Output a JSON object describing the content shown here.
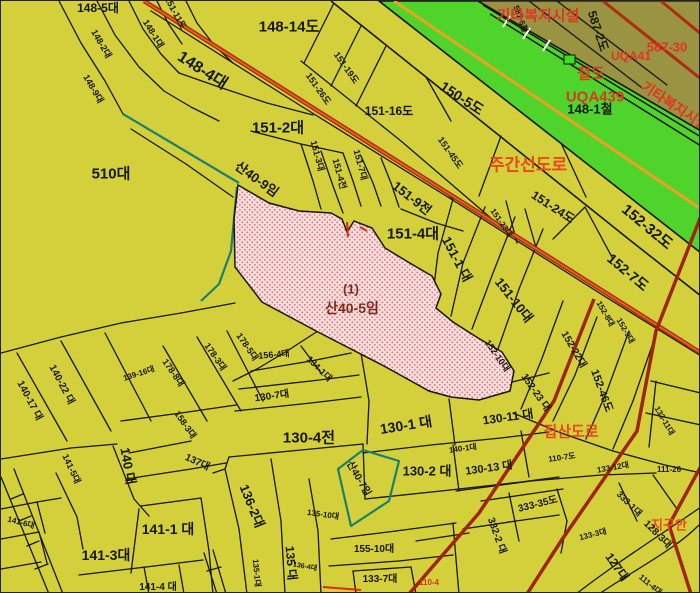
{
  "map": {
    "type": "cadastral-parcel-map",
    "palette": {
      "background": "#d3d03c",
      "olive_zone": "#9a9342",
      "railway_green": "#4fd42c",
      "railway_center_orange": "#efa021",
      "main_road_red": "#a82a10",
      "main_road_core": "#e8611c",
      "minor_road_red": "#9e2610",
      "forest_boundary_teal": "#1b7f6d",
      "highlight_fill": "#f8e0e0",
      "highlight_dot": "#dd7777",
      "ink": "#17160a",
      "road_class": "#e8491d",
      "facility": "#e03522",
      "maroon": "#7d2a1e",
      "tiny_red": "#d93025"
    },
    "highlight_parcel": {
      "marker": "(1)",
      "lot": "산40-5임"
    },
    "labels": [
      {
        "t": "148-5대",
        "x": 97,
        "y": 7,
        "r": 0,
        "s": 12
      },
      {
        "t": "151-11도",
        "x": 174,
        "y": 12,
        "r": 62,
        "s": 9
      },
      {
        "t": "148-14도",
        "x": 288,
        "y": 26,
        "r": 0,
        "s": 15
      },
      {
        "t": "148-4대",
        "x": 201,
        "y": 70,
        "r": 33,
        "s": 16
      },
      {
        "t": "148-1대",
        "x": 152,
        "y": 33,
        "r": 58,
        "s": 9
      },
      {
        "t": "148-2대",
        "x": 100,
        "y": 43,
        "r": 60,
        "s": 9
      },
      {
        "t": "148-9대",
        "x": 92,
        "y": 88,
        "r": 60,
        "s": 9
      },
      {
        "t": "151-2대",
        "x": 277,
        "y": 127,
        "r": 0,
        "s": 15
      },
      {
        "t": "510대",
        "x": 110,
        "y": 173,
        "r": 0,
        "s": 15
      },
      {
        "t": "산40-9임",
        "x": 256,
        "y": 178,
        "r": 36,
        "s": 13
      },
      {
        "t": "150-5도",
        "x": 461,
        "y": 97,
        "r": 33,
        "s": 14
      },
      {
        "t": "151-16도",
        "x": 388,
        "y": 110,
        "r": 0,
        "s": 12
      },
      {
        "t": "151-19도",
        "x": 345,
        "y": 67,
        "r": 55,
        "s": 9
      },
      {
        "t": "151-26도",
        "x": 317,
        "y": 88,
        "r": 55,
        "s": 9
      },
      {
        "t": "151-3대",
        "x": 316,
        "y": 155,
        "r": 75,
        "s": 9
      },
      {
        "t": "151-4전",
        "x": 338,
        "y": 173,
        "r": 75,
        "s": 9
      },
      {
        "t": "151-7대",
        "x": 359,
        "y": 164,
        "r": 75,
        "s": 9
      },
      {
        "t": "151-45도",
        "x": 449,
        "y": 152,
        "r": 55,
        "s": 9
      },
      {
        "t": "151-9전",
        "x": 411,
        "y": 197,
        "r": 38,
        "s": 13
      },
      {
        "t": "151-4대",
        "x": 412,
        "y": 233,
        "r": 0,
        "s": 15
      },
      {
        "t": "151-1 대",
        "x": 456,
        "y": 258,
        "r": 62,
        "s": 13
      },
      {
        "t": "151-10대",
        "x": 513,
        "y": 299,
        "r": 52,
        "s": 13
      },
      {
        "t": "151-23대",
        "x": 500,
        "y": 222,
        "r": 55,
        "s": 8
      },
      {
        "t": "151-24도",
        "x": 552,
        "y": 206,
        "r": 33,
        "s": 12
      },
      {
        "t": "152-32도",
        "x": 646,
        "y": 226,
        "r": 40,
        "s": 15
      },
      {
        "t": "152-7도",
        "x": 627,
        "y": 271,
        "r": 40,
        "s": 14
      },
      {
        "t": "152-8대",
        "x": 604,
        "y": 313,
        "r": 60,
        "s": 8
      },
      {
        "t": "152-9대",
        "x": 624,
        "y": 330,
        "r": 60,
        "s": 8
      },
      {
        "t": "148-1철",
        "x": 589,
        "y": 108,
        "r": 0,
        "s": 13
      },
      {
        "t": "587-2도",
        "x": 597,
        "y": 30,
        "r": 72,
        "s": 12
      },
      {
        "t": "587-6철",
        "x": 519,
        "y": 18,
        "r": 70,
        "s": 8
      },
      {
        "t": "(1)",
        "x": 350,
        "y": 288,
        "r": 0,
        "s": 13,
        "k": "hl"
      },
      {
        "t": "산40-5임",
        "x": 351,
        "y": 307,
        "r": 0,
        "s": 14,
        "k": "hl"
      },
      {
        "t": "주간선도로",
        "x": 527,
        "y": 164,
        "r": 0,
        "s": 17,
        "k": "rc"
      },
      {
        "t": "집산도로",
        "x": 570,
        "y": 431,
        "r": 0,
        "s": 15,
        "k": "rc"
      },
      {
        "t": "기타복지시설",
        "x": 537,
        "y": 15,
        "r": 0,
        "s": 15,
        "k": "fac"
      },
      {
        "t": "철도",
        "x": 590,
        "y": 73,
        "r": 0,
        "s": 15,
        "k": "fac"
      },
      {
        "t": "UQA439",
        "x": 594,
        "y": 96,
        "r": 0,
        "s": 15,
        "k": "fac"
      },
      {
        "t": "UQA41",
        "x": 630,
        "y": 55,
        "r": 0,
        "s": 12,
        "k": "fac"
      },
      {
        "t": "587-30",
        "x": 666,
        "y": 46,
        "r": 0,
        "s": 13,
        "k": "fac"
      },
      {
        "t": "기타복지시설",
        "x": 674,
        "y": 105,
        "r": 33,
        "s": 14,
        "k": "fac"
      },
      {
        "t": "지구안",
        "x": 668,
        "y": 524,
        "r": 0,
        "s": 13,
        "k": "rc"
      },
      {
        "t": "110-4",
        "x": 428,
        "y": 582,
        "r": 0,
        "s": 8,
        "k": "tr"
      },
      {
        "t": "140-17 대",
        "x": 28,
        "y": 400,
        "r": 62,
        "s": 10
      },
      {
        "t": "140-22 대",
        "x": 60,
        "y": 384,
        "r": 62,
        "s": 10
      },
      {
        "t": "139-16대",
        "x": 138,
        "y": 373,
        "r": -18,
        "s": 8
      },
      {
        "t": "178-8대",
        "x": 172,
        "y": 372,
        "r": 55,
        "s": 9
      },
      {
        "t": "178-3대",
        "x": 214,
        "y": 356,
        "r": 55,
        "s": 9
      },
      {
        "t": "178-5대",
        "x": 246,
        "y": 346,
        "r": 55,
        "s": 9
      },
      {
        "t": "158-3대",
        "x": 184,
        "y": 424,
        "r": 55,
        "s": 9
      },
      {
        "t": "137대",
        "x": 196,
        "y": 462,
        "r": 25,
        "s": 10
      },
      {
        "t": "140 대",
        "x": 127,
        "y": 465,
        "r": 80,
        "s": 13
      },
      {
        "t": "141-5대",
        "x": 70,
        "y": 468,
        "r": 65,
        "s": 9
      },
      {
        "t": "141-6대",
        "x": 20,
        "y": 522,
        "r": 15,
        "s": 8
      },
      {
        "t": "141-1 대",
        "x": 167,
        "y": 528,
        "r": 0,
        "s": 14
      },
      {
        "t": "141-3대",
        "x": 105,
        "y": 554,
        "r": 0,
        "s": 14
      },
      {
        "t": "141-4 대",
        "x": 157,
        "y": 587,
        "r": 0,
        "s": 10
      },
      {
        "t": "136-2대",
        "x": 251,
        "y": 505,
        "r": 68,
        "s": 13
      },
      {
        "t": "135 대",
        "x": 290,
        "y": 562,
        "r": 85,
        "s": 12
      },
      {
        "t": "135-1대",
        "x": 255,
        "y": 572,
        "r": 85,
        "s": 8
      },
      {
        "t": "135-10대",
        "x": 322,
        "y": 514,
        "r": 8,
        "s": 8
      },
      {
        "t": "136-4대",
        "x": 304,
        "y": 566,
        "r": 10,
        "s": 7
      },
      {
        "t": "155-10대",
        "x": 373,
        "y": 549,
        "r": 0,
        "s": 10
      },
      {
        "t": "133-7대",
        "x": 379,
        "y": 579,
        "r": 0,
        "s": 10
      },
      {
        "t": "130-7대",
        "x": 271,
        "y": 396,
        "r": -8,
        "s": 10
      },
      {
        "t": "134-1대",
        "x": 318,
        "y": 368,
        "r": 45,
        "s": 9
      },
      {
        "t": "156-4대",
        "x": 273,
        "y": 354,
        "r": -5,
        "s": 9
      },
      {
        "t": "130-4전",
        "x": 308,
        "y": 437,
        "r": 0,
        "s": 15
      },
      {
        "t": "130-1 대",
        "x": 405,
        "y": 424,
        "r": -9,
        "s": 14
      },
      {
        "t": "130-2 대",
        "x": 426,
        "y": 470,
        "r": 0,
        "s": 13
      },
      {
        "t": "130-11 대",
        "x": 507,
        "y": 416,
        "r": -8,
        "s": 12
      },
      {
        "t": "130-13 대",
        "x": 488,
        "y": 468,
        "r": -8,
        "s": 11
      },
      {
        "t": "140-1대",
        "x": 462,
        "y": 448,
        "r": -8,
        "s": 8
      },
      {
        "t": "산40-7임",
        "x": 357,
        "y": 478,
        "r": 60,
        "s": 10
      },
      {
        "t": "152-10대",
        "x": 496,
        "y": 355,
        "r": 55,
        "s": 9
      },
      {
        "t": "152-22대",
        "x": 572,
        "y": 349,
        "r": 60,
        "s": 10
      },
      {
        "t": "152-23 대",
        "x": 534,
        "y": 392,
        "r": 55,
        "s": 10
      },
      {
        "t": "152-46도",
        "x": 600,
        "y": 390,
        "r": 70,
        "s": 11
      },
      {
        "t": "133-11대",
        "x": 663,
        "y": 420,
        "r": 60,
        "s": 8
      },
      {
        "t": "111-26",
        "x": 668,
        "y": 469,
        "r": 0,
        "s": 8
      },
      {
        "t": "110-7도",
        "x": 561,
        "y": 457,
        "r": -8,
        "s": 8
      },
      {
        "t": "133-12대",
        "x": 612,
        "y": 467,
        "r": -10,
        "s": 8
      },
      {
        "t": "332-2 대",
        "x": 495,
        "y": 535,
        "r": 70,
        "s": 10
      },
      {
        "t": "333-35도",
        "x": 537,
        "y": 504,
        "r": -14,
        "s": 10
      },
      {
        "t": "133-3대",
        "x": 592,
        "y": 534,
        "r": -14,
        "s": 8
      },
      {
        "t": "333-1대",
        "x": 628,
        "y": 503,
        "r": 45,
        "s": 9
      },
      {
        "t": "127대",
        "x": 616,
        "y": 566,
        "r": 55,
        "s": 12
      },
      {
        "t": "128-3대",
        "x": 656,
        "y": 534,
        "r": 45,
        "s": 10
      },
      {
        "t": "111-4대",
        "x": 649,
        "y": 584,
        "r": 40,
        "s": 8
      }
    ]
  }
}
